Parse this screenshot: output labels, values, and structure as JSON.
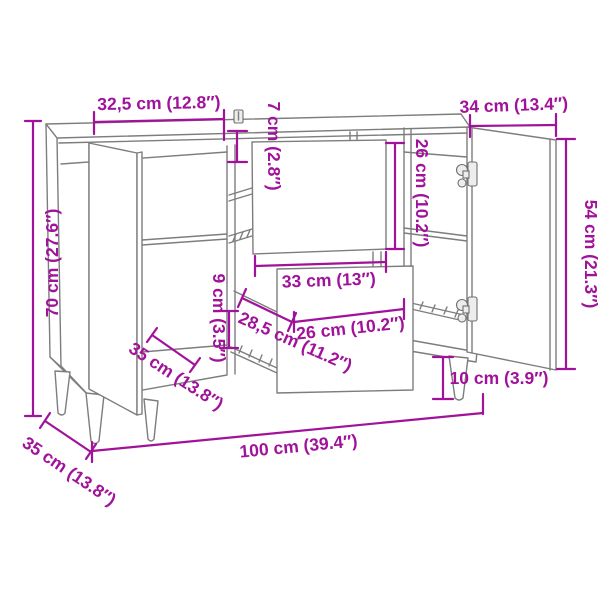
{
  "title": "Sideboard dimension diagram",
  "colors": {
    "dimension": "#a1129b",
    "furniture_line": "#7d7d7d",
    "background": "#ffffff"
  },
  "dimensions": {
    "top_section_width": "32,5 cm (12.8″)",
    "right_door_width": "34 cm (13.4″)",
    "top_clearance": "7 cm (2.8″)",
    "drawer_front_height": "26 cm (10.2″)",
    "overall_height": "70 cm (27.6″)",
    "door_height": "54 cm (21.3″)",
    "drawer_gap_height": "9 cm (3.5″)",
    "drawer_width_outer": "33 cm (13″)",
    "drawer_width_inner": "26 cm (10.2″)",
    "drawer_depth": "28,5 cm (11.2″)",
    "interior_depth": "35 cm (13.8″)",
    "overall_depth": "35 cm (13.8″)",
    "leg_height": "10 cm (3.9″)",
    "overall_width": "100 cm (39.4″)"
  }
}
